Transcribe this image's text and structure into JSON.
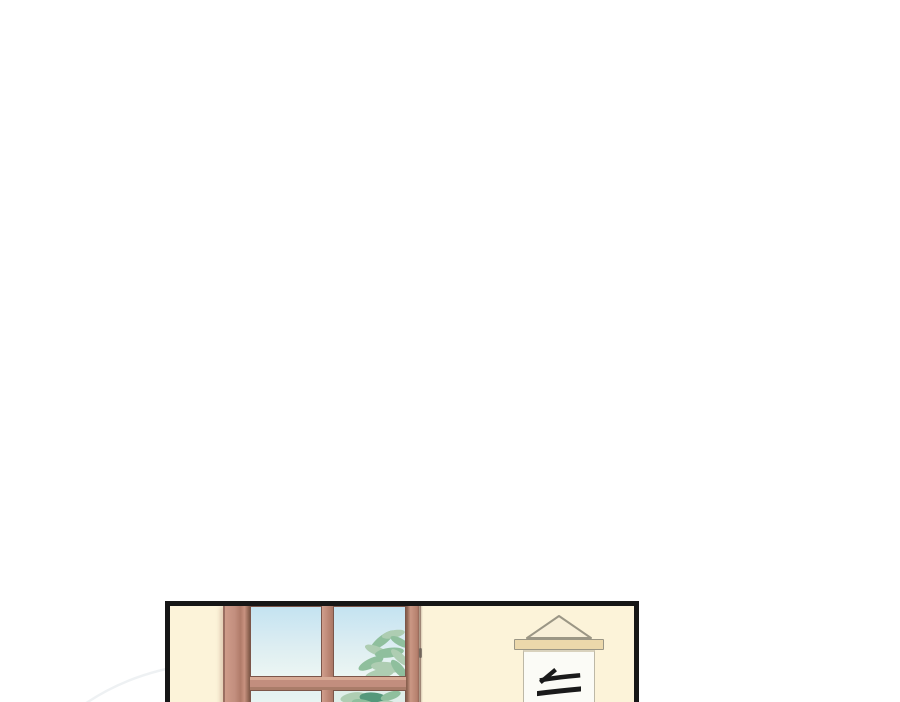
{
  "scene": {
    "panel_count": 1,
    "setting": "classroom wall with window and hanging calligraphy scroll"
  },
  "scroll": {
    "character": "天"
  },
  "colors": {
    "panel-border": "#161616",
    "wall": "#fcf3d9",
    "frame": "#c28e7e",
    "frame-dark": "#7c564a",
    "sky-top": "#c4e3f1",
    "sky-bottom": "#ecf6f3",
    "leaf-light": "#aecdb2",
    "leaf-mid": "#8fbf9d",
    "leaf-dark": "#55987b",
    "rod": "#ecd8ab",
    "triangle": "#f8efd8",
    "scroll-outline": "#9b9685",
    "paper": "#fbfbf6",
    "paper-outline": "#bdb8a6",
    "ink": "#1a1a1a",
    "arc": "#eef1f3",
    "shadow": "#b4a18f"
  }
}
